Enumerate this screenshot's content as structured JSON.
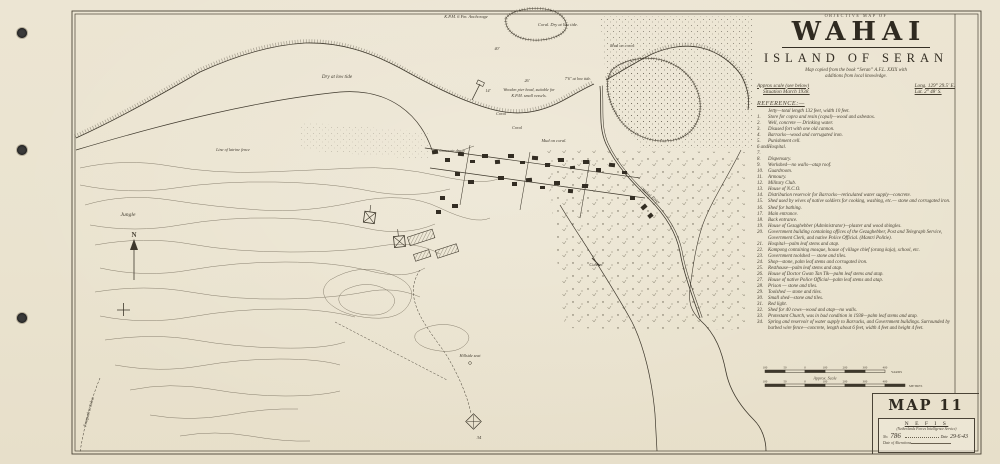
{
  "palette": {
    "paper": "#ebe4d1",
    "ink": "#3e382c",
    "hole_color": "#3a3a3a"
  },
  "title_block": {
    "kicker": "OBJECTIVE MAP OF",
    "title": "WAHAI",
    "subtitle": "ISLAND OF SERAN",
    "note_line1": "Map copied from the book “Seran” A.F.L. XXIX with",
    "note_line2": "additions from local knowledge.",
    "scale_note": "Approx scale (see below)",
    "situation": "Situation March 1938.",
    "longitude": "Long. 129° 29.5′ E.",
    "latitude": "Lat. 2° 48′ S."
  },
  "reference": {
    "heading": "REFERENCE:—",
    "items": [
      {
        "num": "",
        "text": "Jetty—total length 132 feet, width 10 feet."
      },
      {
        "num": "1.",
        "text": "Store for copra and resin (copal)—wood and asbestos."
      },
      {
        "num": "2.",
        "text": "Well, concrete — Drinking water."
      },
      {
        "num": "3.",
        "text": "Disused fort with one old cannon."
      },
      {
        "num": "4.",
        "text": "Barracks—wood and corrugated iron."
      },
      {
        "num": "5.",
        "text": "Punishment cell."
      },
      {
        "num": "6 and 7.",
        "text": "Hospital."
      },
      {
        "num": "8.",
        "text": "Dispensary."
      },
      {
        "num": "9.",
        "text": "Workshed—no walls—atap roof."
      },
      {
        "num": "10.",
        "text": "Guardroom."
      },
      {
        "num": "11.",
        "text": "Armoury."
      },
      {
        "num": "12.",
        "text": "Military Club."
      },
      {
        "num": "13.",
        "text": "House of N.C.O."
      },
      {
        "num": "14.",
        "text": "Distribution reservoir for Barracks—reticulated water supply—concrete."
      },
      {
        "num": "15.",
        "text": "Shed used by wives of native soldiers for cooking, washing, etc.— stone and corrugated iron."
      },
      {
        "num": "16.",
        "text": "Shed for bathing."
      },
      {
        "num": "17.",
        "text": "Main entrance."
      },
      {
        "num": "18.",
        "text": "Back entrance."
      },
      {
        "num": "19.",
        "text": "House of Gezaghebber (Administrator)—plaster and wood shingles."
      },
      {
        "num": "20.",
        "text": "Government building containing offices of the Gezaghebber, Post and Telegraph Service, Government Clerk, and native Police Official. (Mantri Politie)."
      },
      {
        "num": "21.",
        "text": "Hospital—palm leaf stems and atap."
      },
      {
        "num": "22.",
        "text": "Kampong containing mosque, house of village chief (orang kaja), school, etc."
      },
      {
        "num": "23.",
        "text": "Government toolshed — stone and tiles."
      },
      {
        "num": "24.",
        "text": "Shop—stone, palm leaf stems and corrugated iron."
      },
      {
        "num": "25.",
        "text": "Resthouse—palm leaf stems and atap."
      },
      {
        "num": "26.",
        "text": "House of Doctor Gwan Tan Tik—palm leaf stems and atap."
      },
      {
        "num": "27.",
        "text": "House of native Police Official—palm leaf stems and atap."
      },
      {
        "num": "28.",
        "text": "Prison — stone and tiles."
      },
      {
        "num": "29.",
        "text": "Toolshed — stone and tiles."
      },
      {
        "num": "30.",
        "text": "Small shed—stone and tiles."
      },
      {
        "num": "31.",
        "text": "Red light."
      },
      {
        "num": "32.",
        "text": "Shed for 40 cows—wood and atap—no walls."
      },
      {
        "num": "33.",
        "text": "Protestant Church, was in bad condition in 1938—palm leaf stems and atap."
      },
      {
        "num": "34.",
        "text": "Spring and reservoir of water supply to Barracks, and Government buildings. Surrounded by barbed wire fence—concrete, length about 6 feet, width 4 feet and height 4 feet."
      }
    ]
  },
  "scale_bars": {
    "caption": "Approx. Scale",
    "yards_unit": "YARDS",
    "metres_unit": "METRES",
    "yards_ticks": [
      "100",
      "50",
      "0",
      "100",
      "200",
      "300",
      "400"
    ],
    "metres_ticks": [
      "100",
      "50",
      "0",
      "100",
      "200",
      "300",
      "400"
    ]
  },
  "corner_panel": {
    "map_number": "MAP 11",
    "agency": "N E F I S",
    "agency_full": "(Netherlands Forces Intelligence Service)",
    "no_label": "No.",
    "no_value": "786",
    "date_label": "Date",
    "date_value": "29·6·43",
    "alterations_label": "Date of Alterations"
  },
  "map_labels": {
    "anchorage": "K.P.M. 6 Fm. Anchorage",
    "coral_dry": "Coral.  Dry at low tide.",
    "mud_on_coral_ne": "Mud on coral",
    "depth40": "40′",
    "dry_low_tide": "Dry at low tide",
    "depth26": "26′",
    "depth14": "14′",
    "depth76": "7′6″ at low tide.",
    "pier_line1": "Wooden pier head, suitable for",
    "pier_line2": "K.P.M. small vessels.",
    "coral_a": "Coral",
    "coral_b": "Coral",
    "mud_on_coral": "Mud on coral.",
    "drain": "Concrete drain",
    "river": "Wahai River",
    "culvert": "Culvert",
    "jungle": "Jungle",
    "fence": "Line of latrine fence",
    "hillside_seat": "Hillside seat",
    "spring_no": "34",
    "north": "N",
    "footpath": "Footpath to Solea."
  }
}
